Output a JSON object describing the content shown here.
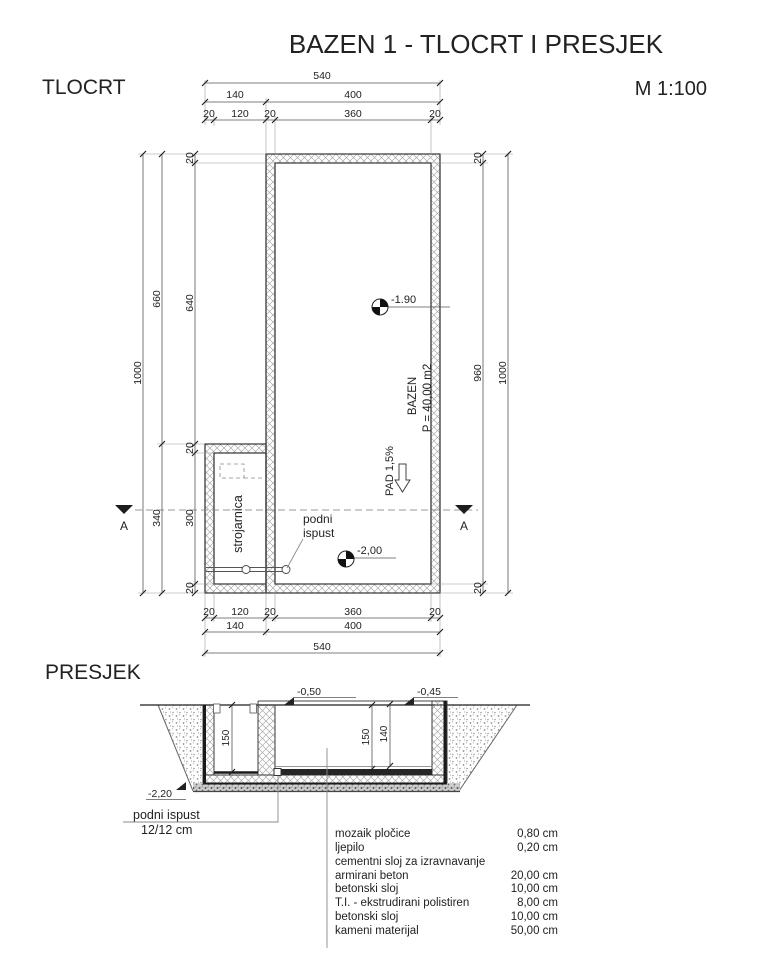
{
  "ink": "#333333",
  "title": "BAZEN 1 - TLOCRT I PRESJEK",
  "plan": {
    "label": "TLOCRT",
    "scale": "M 1:100",
    "machine_room": "strojarnica",
    "pool_name": "BAZEN",
    "pool_area": "P = 40,00 m2",
    "slope": "PAD 1,5%",
    "floor_drain_line1": "podni",
    "floor_drain_line2": "ispust",
    "level_basin": "-1.90",
    "level_drain": "-2,00",
    "section_marker": "A",
    "dims": {
      "total_w": "540",
      "mid_w": [
        "140",
        "400"
      ],
      "detail_w": [
        "20",
        "120",
        "20",
        "360",
        "20"
      ],
      "total_h": "1000",
      "mid_h": [
        "660",
        "340"
      ],
      "detail_h": [
        "20",
        "640",
        "20",
        "300",
        "20"
      ],
      "right_h": [
        "20",
        "960",
        "20"
      ]
    }
  },
  "section": {
    "label": "PRESJEK",
    "level_top_left": "-0,50",
    "level_top_right": "-0,45",
    "level_bottom": "-2,20",
    "depth_room": "150",
    "depth_pool": "150",
    "depth_water": "140",
    "drain_note1": "podni ispust",
    "drain_note2": "12/12 cm",
    "materials": [
      {
        "name": "mozaik pločice",
        "value": "0,80 cm"
      },
      {
        "name": "ljepilo",
        "value": "0,20 cm"
      },
      {
        "name": "cementni sloj za izravnavanje",
        "value": ""
      },
      {
        "name": "armirani beton",
        "value": "20,00 cm"
      },
      {
        "name": "betonski sloj",
        "value": "10,00 cm"
      },
      {
        "name": "T.I. - ekstrudirani polistiren",
        "value": "8,00 cm"
      },
      {
        "name": "betonski sloj",
        "value": "10,00 cm"
      },
      {
        "name": "kameni materijal",
        "value": "50,00 cm"
      }
    ]
  }
}
